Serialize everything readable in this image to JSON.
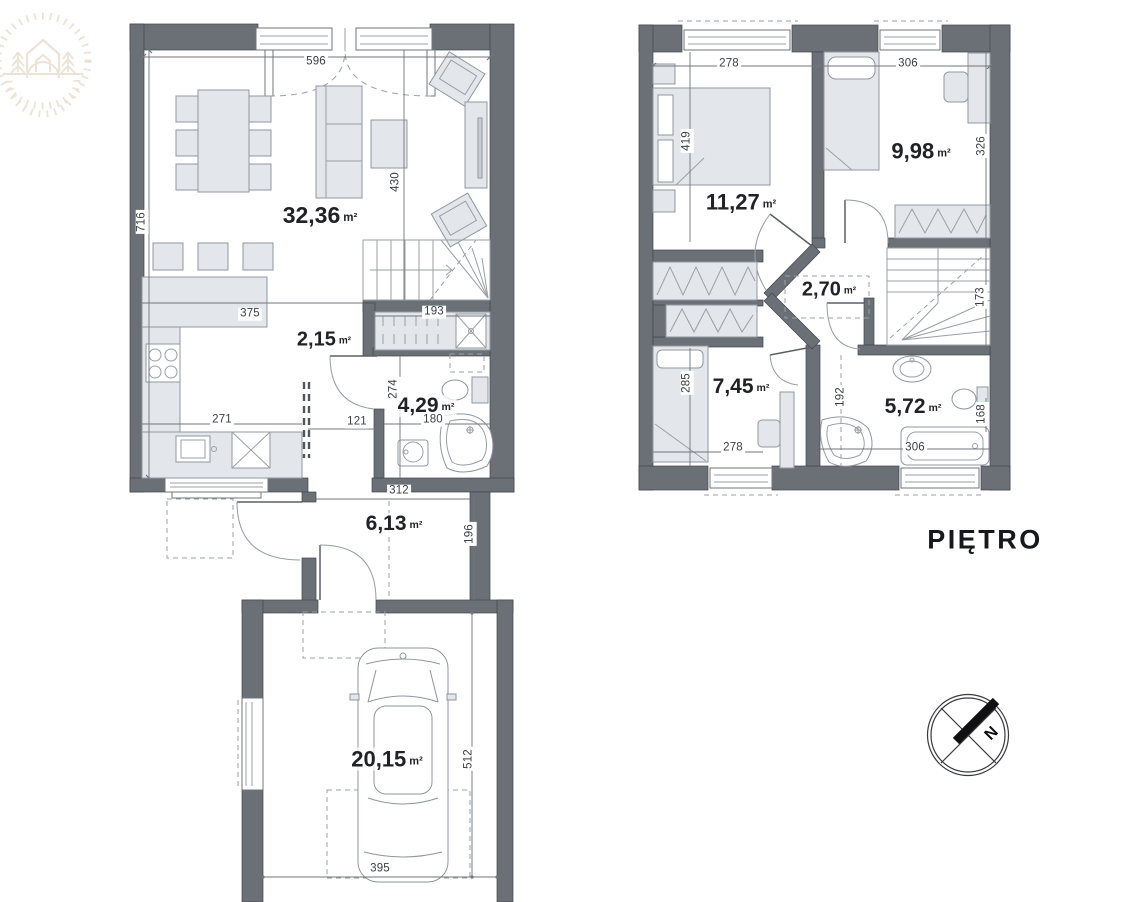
{
  "floors": {
    "ground": {
      "rooms": {
        "living": {
          "area": "32,36",
          "unit": "m²"
        },
        "hall": {
          "area": "2,15",
          "unit": "m²"
        },
        "bathroom": {
          "area": "4,29",
          "unit": "m²"
        },
        "entry": {
          "area": "6,13",
          "unit": "m²"
        },
        "garage": {
          "area": "20,15",
          "unit": "m²"
        }
      },
      "dims": {
        "living_width": "596",
        "living_left": "716",
        "living_depth": "430",
        "kitchen_width": "375",
        "counter_width": "271",
        "hall_door": "121",
        "bath_depth": "274",
        "bath_width": "180",
        "storage_width": "193",
        "entry_width": "312",
        "entry_depth": "196",
        "garage_depth": "512",
        "garage_width": "395"
      }
    },
    "upper": {
      "label": "PIĘTRO",
      "rooms": {
        "bedroom1": {
          "area": "11,27",
          "unit": "m²"
        },
        "bedroom2": {
          "area": "9,98",
          "unit": "m²"
        },
        "hall": {
          "area": "2,70",
          "unit": "m²"
        },
        "bedroom3": {
          "area": "7,45",
          "unit": "m²"
        },
        "bathroom": {
          "area": "5,72",
          "unit": "m²"
        }
      },
      "dims": {
        "bedroom1_width": "278",
        "bedroom2_width": "306",
        "bedroom1_depth": "419",
        "bedroom2_depth": "326",
        "stairs_width": "173",
        "bedroom3_depth": "285",
        "bedroom3_width": "278",
        "bath_mid": "192",
        "bath_right": "168",
        "bath_width": "306"
      }
    }
  },
  "compass": {
    "north": "N"
  },
  "colors": {
    "wall": "#6b6f76",
    "wall_stroke": "#42464d",
    "furniture": "#e3e6ea",
    "furniture_stroke": "#9098a0",
    "line": "#9aa0a7",
    "dim_line": "#70767c",
    "text": "#212226",
    "dim_text": "#3b3e43",
    "logo": "#eae0d2"
  }
}
